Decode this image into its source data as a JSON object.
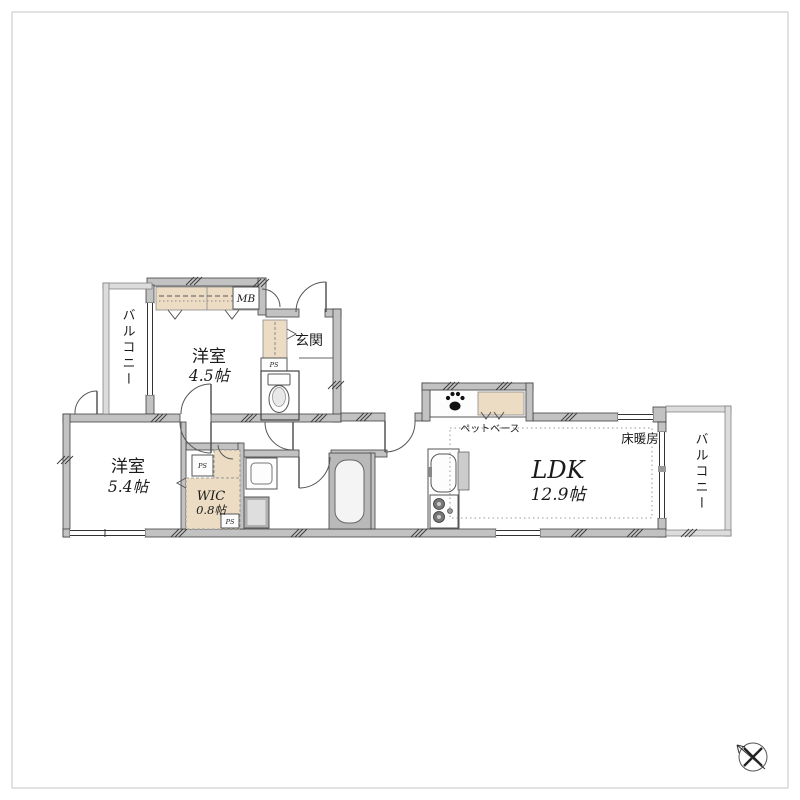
{
  "labels": {
    "balcony_left": "バルコニー",
    "balcony_right": "バルコニー",
    "room1_name": "洋室",
    "room1_size": "4.5帖",
    "room2_name": "洋室",
    "room2_size": "5.4帖",
    "entrance": "玄関",
    "meter_box": "MB",
    "pipe_space": "PS",
    "wic_name": "WIC",
    "wic_size": "0.8帖",
    "ldk_name": "LDK",
    "ldk_size": "12.9帖",
    "floor_heating": "床暖房",
    "pet_base": "ペットベース"
  },
  "colors": {
    "wall": "#c2c2c2",
    "accent_beige": "#ecdcc3",
    "bath_gray": "#b9b9b9",
    "outline": "#3f3f3f",
    "background": "#ffffff"
  }
}
